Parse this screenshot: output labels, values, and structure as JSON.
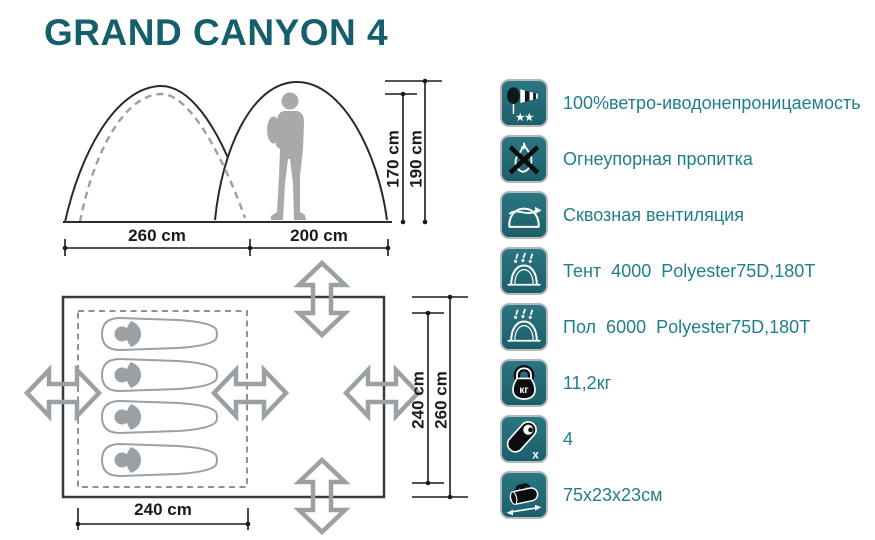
{
  "title": "GRAND CANYON 4",
  "colors": {
    "title": "#155f6a",
    "feature_text": "#1f7e8c",
    "badge_teal": "#236f7a",
    "badge_border": "#b5b9b9",
    "dimension_text": "#1a1a1a",
    "diagram_gray": "#9aa0a3"
  },
  "elevation": {
    "width_left": "260 cm",
    "width_right": "200 cm",
    "height_inner": "170 cm",
    "height_outer": "190 cm"
  },
  "floorplan": {
    "bottom_width": "240 cm",
    "inner_depth": "240 cm",
    "outer_depth": "260 cm",
    "sleeping_bag_count": 4
  },
  "features": [
    {
      "icon": "windsock-icon",
      "label": "100%ветро-иводонепроницаемость"
    },
    {
      "icon": "no-fire-icon",
      "label": "Огнеупорная пропитка"
    },
    {
      "icon": "ventilation-icon",
      "label": "Сквозная вентиляция"
    },
    {
      "icon": "tent-waterproof-icon",
      "label": "Тент  4000  Polyester75D,180T"
    },
    {
      "icon": "floor-waterproof-icon",
      "label": "Пол  6000  Polyester75D,180T"
    },
    {
      "icon": "weight-icon",
      "label": "11,2кг",
      "icon_text": "кг"
    },
    {
      "icon": "capacity-icon",
      "label": "4",
      "icon_text": "x"
    },
    {
      "icon": "packed-size-icon",
      "label": "75х23х23см"
    }
  ]
}
